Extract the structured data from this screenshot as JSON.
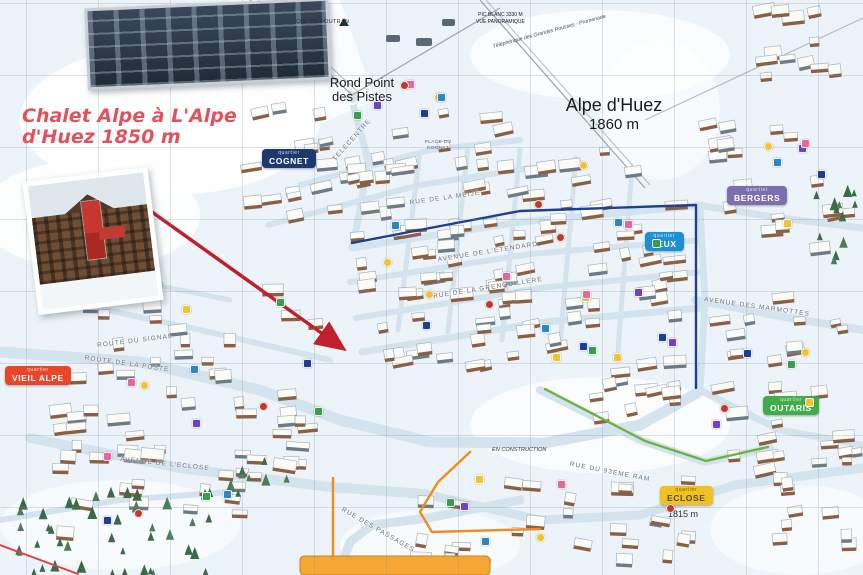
{
  "annotation": {
    "text": "Chalet Alpe à L'Alpe d'Huez 1850 m",
    "color": "#e0535d",
    "arrow_color": "#c01f2e"
  },
  "resort": {
    "name": "Alpe d'Huez",
    "altitude": "1860 m"
  },
  "landmarks": {
    "rond_point": "Rond Point des Pistes",
    "col_du_poutran": "COL DU POUTRAN",
    "pic_blanc": "PIC BLANC 3330 M",
    "vue_panoramique": "VUE PANORAMIQUE",
    "telepherique": "Téléphérique des Grandes Rousses - Promenade",
    "place_du_cognet": "PLACE DU COGNET",
    "en_construction": "EN CONSTRUCTION",
    "eclose_altitude": "1815 m"
  },
  "quartiers": [
    {
      "tag": "quartier",
      "name": "COGNET",
      "bg": "#1d3a6e",
      "fg": "#ffffff",
      "x": 262,
      "y": 149
    },
    {
      "tag": "quartier",
      "name": "BERGERS",
      "bg": "#7b6fae",
      "fg": "#ffffff",
      "x": 727,
      "y": 186
    },
    {
      "tag": "quartier",
      "name": "JEUX",
      "bg": "#1e8fd5",
      "fg": "#ffffff",
      "x": 645,
      "y": 232
    },
    {
      "tag": "quartier",
      "name": "VIEIL ALPE",
      "bg": "#e8452b",
      "fg": "#ffffff",
      "x": 5,
      "y": 366
    },
    {
      "tag": "quartier",
      "name": "OUTARIS",
      "bg": "#3fae49",
      "fg": "#ffffff",
      "x": 763,
      "y": 396
    },
    {
      "tag": "quartier",
      "name": "ECLOSE",
      "bg": "#f1c021",
      "fg": "#5a4a00",
      "x": 660,
      "y": 486
    }
  ],
  "streets": [
    {
      "text": "ROUTE DU SIGNAL",
      "x": 135,
      "y": 341,
      "angle": -7
    },
    {
      "text": "ROUTE DE LA POSTE",
      "x": 127,
      "y": 364,
      "angle": 8
    },
    {
      "text": "AVENUE DE L'ECLOSE",
      "x": 165,
      "y": 464,
      "angle": 6
    },
    {
      "text": "AVENUE DES MARMOTTES",
      "x": 757,
      "y": 307,
      "angle": 8
    },
    {
      "text": "RUE DES PASSAGES",
      "x": 378,
      "y": 530,
      "angle": 30
    },
    {
      "text": "RUE DU 93EME RAM",
      "x": 610,
      "y": 472,
      "angle": 11
    },
    {
      "text": "AVENUE DE L'ETENDARD",
      "x": 488,
      "y": 252,
      "angle": -9
    },
    {
      "text": "RUE DE LA GRENOUILLERE",
      "x": 488,
      "y": 288,
      "angle": -9
    },
    {
      "text": "TELECENTRE",
      "x": 352,
      "y": 140,
      "angle": -48
    },
    {
      "text": "RUE DE LA MEIJE",
      "x": 445,
      "y": 198,
      "angle": -8
    }
  ],
  "photos": {
    "top_inset": "apartment-building-photo",
    "left_inset": "chalet-photo"
  },
  "route_colors": {
    "navy": "#1d3f8f",
    "green": "#6db33f",
    "orange": "#f08c1e"
  }
}
